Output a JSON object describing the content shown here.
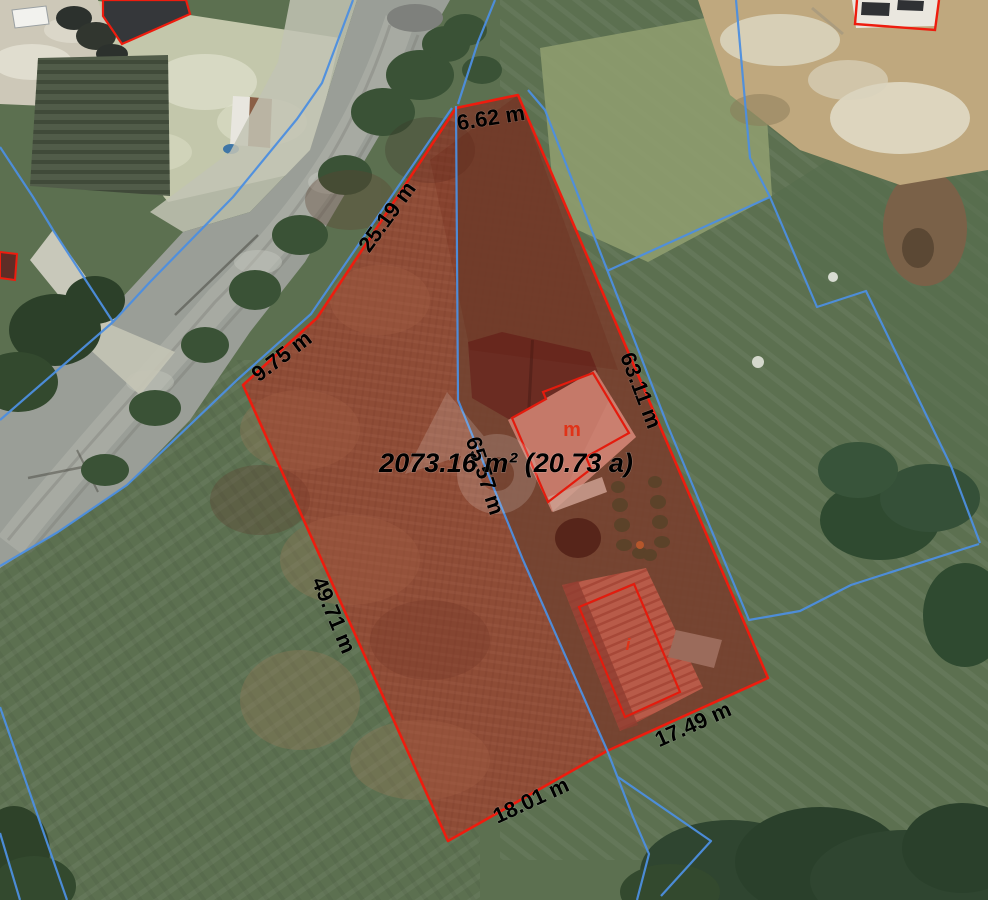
{
  "map_overlay": {
    "type": "aerial-parcel-measurement",
    "area_label": "2073.16 m² (20.73 a)",
    "side_measurements": [
      {
        "id": "top-edge",
        "label": "6.62 m"
      },
      {
        "id": "upper-left-edge",
        "label": "25.19 m"
      },
      {
        "id": "left-short-edge",
        "label": "9.75 m"
      },
      {
        "id": "right-edge",
        "label": "63.11 m"
      },
      {
        "id": "middle-line",
        "label": "65.57 m"
      },
      {
        "id": "left-long-edge",
        "label": "49.71 m"
      },
      {
        "id": "bottom-right-edge",
        "label": "17.49 m"
      },
      {
        "id": "bottom-edge",
        "label": "18.01 m"
      }
    ],
    "building_marks": [
      {
        "id": "main-house-mark",
        "label": "m"
      },
      {
        "id": "barn-mark",
        "label": "i"
      }
    ],
    "colors": {
      "parcel_outline": "#ee1c0e",
      "parcel_fill_tint": "rgba(198,26,14,0.24)",
      "cadastral_line": "#4d8fe0",
      "dimension_text": "#000000",
      "building_mark": "#e03318"
    }
  }
}
